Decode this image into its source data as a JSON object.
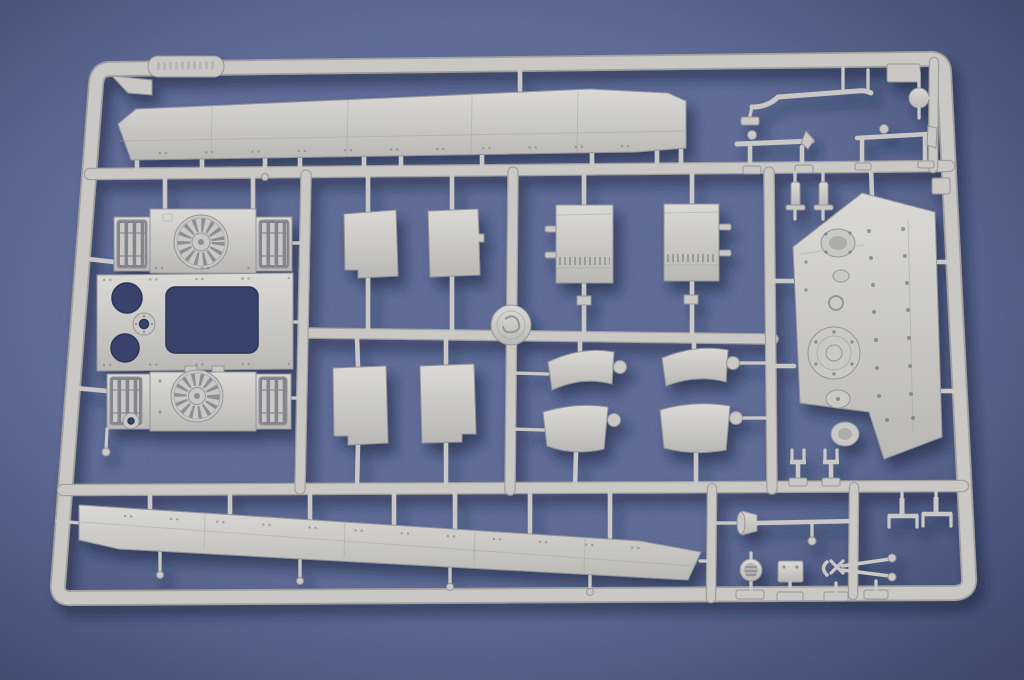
{
  "meta": {
    "title": "Plastic model kit sprue",
    "description": "Photograph of a light grey injection-molded plastic model kit sprue (parts tree) with tank hull parts, lying on a blue textured background"
  },
  "colors": {
    "bg": "#4d5b8a",
    "bgDark": "#333d63",
    "shadow": "#131c3a",
    "plastic": "#c9c8c5",
    "plasticLight": "#dededa",
    "plasticDark": "#a09f9c",
    "plasticEdge": "#94939a",
    "hole": "#39436b",
    "holeEdge": "#2c3557",
    "grilleDark": "#85848e",
    "detailDark": "#6c6c78"
  },
  "sprue": {
    "material": "light grey polystyrene",
    "background_surface": "blue textured board",
    "label_tag": {
      "present": true,
      "text_legible": false
    },
    "parts_inventory": [
      {
        "name": "upper-hull-side-panel",
        "count": 1
      },
      {
        "name": "lower-hull-side-panel",
        "count": 1
      },
      {
        "name": "engine-deck-section-with-fan-grille",
        "count": 2
      },
      {
        "name": "engine-deck-center-plate-with-cutout",
        "count": 1
      },
      {
        "name": "rectangular-access-panel",
        "count": 4
      },
      {
        "name": "hinged-hatch-cover",
        "count": 2
      },
      {
        "name": "curved-fender-section",
        "count": 4
      },
      {
        "name": "angled-bulkhead-panel-with-bosses",
        "count": 1
      },
      {
        "name": "bent-grab-rod",
        "count": 1
      },
      {
        "name": "ball-knob",
        "count": 1
      },
      {
        "name": "tool-rod-with-spike",
        "count": 1
      },
      {
        "name": "tool-rod-with-head",
        "count": 1
      },
      {
        "name": "cylindrical-fitting",
        "count": 2
      },
      {
        "name": "u-shaped-bracket",
        "count": 2
      },
      {
        "name": "hook-bracket",
        "count": 2
      },
      {
        "name": "cleaning-rod-with-funnel",
        "count": 1
      },
      {
        "name": "gauge-dial",
        "count": 1
      },
      {
        "name": "small-plate",
        "count": 1
      },
      {
        "name": "wire-cutters",
        "count": 1
      },
      {
        "name": "round-connector-peg",
        "count": 4
      }
    ]
  }
}
